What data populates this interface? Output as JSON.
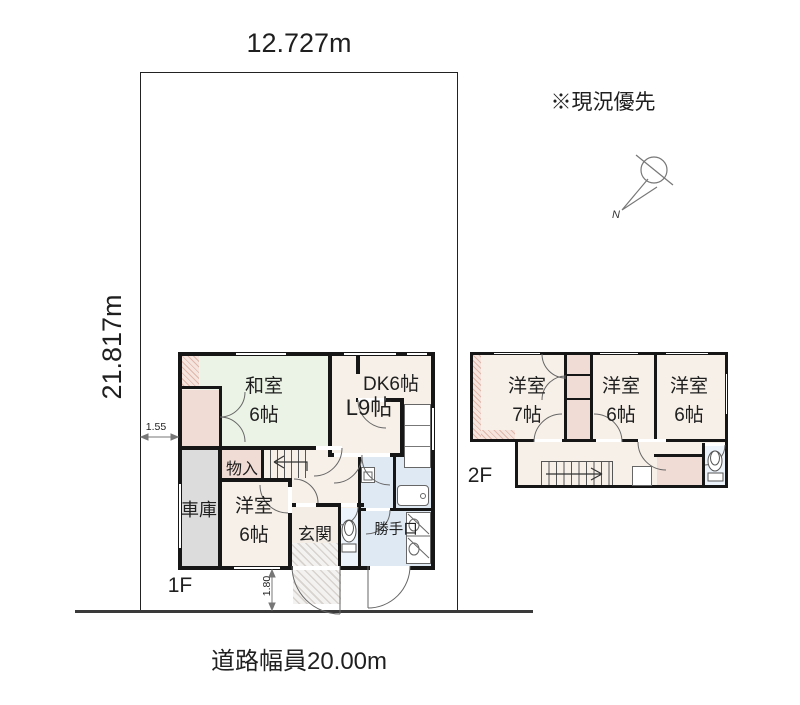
{
  "annotations": {
    "note": "※現況優先",
    "road": "道路幅員20.00m",
    "site_width": "12.727m",
    "site_depth": "21.817m",
    "dim_left": "1.55",
    "dim_bottom": "1.80",
    "floor1": "1F",
    "floor2": "2F",
    "compass_north": "N"
  },
  "floor1": {
    "washitsu": {
      "name": "和室",
      "size": "6帖"
    },
    "living": {
      "name": "L9帖"
    },
    "dk": {
      "name": "DK6帖"
    },
    "storage": {
      "name": "物入"
    },
    "garage": {
      "name": "車庫"
    },
    "bedroom": {
      "name": "洋室",
      "size": "6帖"
    },
    "entrance": {
      "name": "玄関"
    },
    "backdoor": {
      "name": "勝手口"
    }
  },
  "floor2": {
    "bedroom1": {
      "name": "洋室",
      "size": "7帖"
    },
    "bedroom2": {
      "name": "洋室",
      "size": "6帖"
    },
    "bedroom3": {
      "name": "洋室",
      "size": "6帖"
    }
  },
  "colors": {
    "tatami": "#eaf3e5",
    "wood": "#f7f0e8",
    "closet": "#f1dcd5",
    "garage": "#dcdcdc",
    "wet": "#dfe9f3",
    "toilet": "#edf3fa",
    "wall": "#161616"
  }
}
